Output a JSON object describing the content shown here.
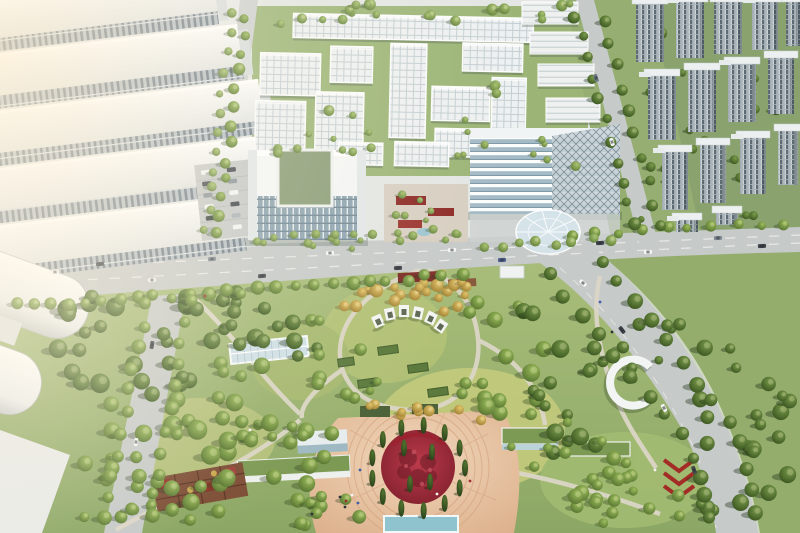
{
  "scene": {
    "title": "Aerial rendering of a technology campus masterplan with a central landscaped park",
    "description": "Bird's-eye photorealistic visualization: white factory halls at upper left, a white courtyard office campus at top center, dense rows of residential high-rise slabs at upper right, a U-shaped headquarters and a banded glass office building along an east-west arterial road, a large park with winding paths and a circular red flower plaza, and barrel-vaulted warehouses at lower left.",
    "style": "photorealistic CGI masterplan rendering",
    "lighting": "warm hazy daylight, sun glow from the upper left"
  },
  "regions": {
    "factory_district": {
      "label": "Factory halls district",
      "position": "top-left"
    },
    "office_campus": {
      "label": "Courtyard office campus",
      "position": "top-center"
    },
    "residential_towers": {
      "label": "Residential tower rows",
      "position": "top-right"
    },
    "headquarters_building": {
      "label": "U-shaped headquarters building",
      "position": "center"
    },
    "glass_office_building": {
      "label": "Glass office building with round entrance canopy",
      "position": "center-right"
    },
    "entry_plaza": {
      "label": "Entry plaza with red pavilions",
      "position": "center"
    },
    "main_road": {
      "label": "East-west arterial road with traffic",
      "position": "middle"
    },
    "side_road_southeast": {
      "label": "Curving southeast park road",
      "position": "bottom-right"
    },
    "side_road_west": {
      "label": "West service road",
      "position": "bottom-left"
    },
    "central_park": {
      "label": "Central landscaped park with winding paths",
      "position": "bottom-center"
    },
    "flower_plaza": {
      "label": "Circular plaza with red flower bed, cypress ring and terracotta paving",
      "position": "bottom-center"
    },
    "greenhouse": {
      "label": "Glass greenhouse pavilion",
      "position": "center-left"
    },
    "warehouses": {
      "label": "Barrel-roof warehouses",
      "position": "bottom-left"
    },
    "parking_lot": {
      "label": "Surface parking lot",
      "position": "center-left"
    }
  },
  "palette": {
    "building_white": "#f2f4f4",
    "campus_grid": "#eef1f1",
    "glass_blue": "#8da3b0",
    "residential_facade": "#ccd4d8",
    "road_gray": "#c6cac9",
    "park_green": "#93ad68",
    "lawn_yellow_green": "#c6cc7d",
    "tree_dark_green": "#3a5722",
    "tree_gold": "#c9a94f",
    "flower_red": "#9e2332",
    "paving_terracotta": "#e2b894",
    "pool_teal": "#8fc3cd",
    "haze_warm": "#ffeecd"
  },
  "counts": {
    "factory_rows": 5,
    "tower_rows": 3,
    "warehouse_vaults": 3
  }
}
